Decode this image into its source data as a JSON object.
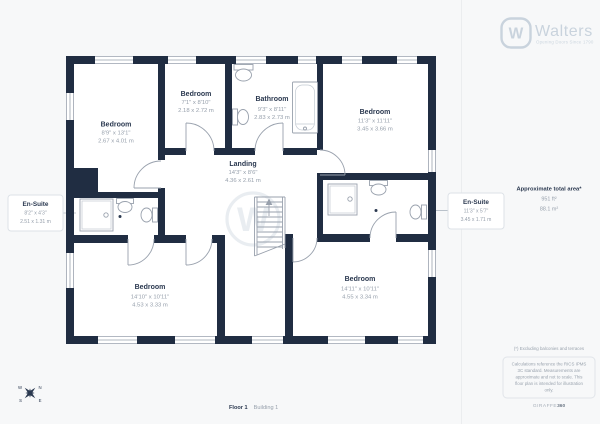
{
  "brand": {
    "monogram": "W",
    "name": "Walters",
    "tagline": "Opening Doors Since 1790"
  },
  "watermark": "W",
  "rooms": [
    {
      "name": "Bedroom",
      "imperial": "8'9\" x 13'1\"",
      "metric": "2.67 x 4.01 m"
    },
    {
      "name": "Bedroom",
      "imperial": "7'1\" x 8'10\"",
      "metric": "2.18 x 2.72 m"
    },
    {
      "name": "Bathroom",
      "imperial": "9'3\" x 8'11\"",
      "metric": "2.83 x 2.73 m"
    },
    {
      "name": "Bedroom",
      "imperial": "11'3\" x 11'11\"",
      "metric": "3.45 x 3.66 m"
    },
    {
      "name": "Landing",
      "imperial": "14'3\" x 8'6\"",
      "metric": "4.36 x 2.61 m"
    },
    {
      "name": "Bedroom",
      "imperial": "14'10\" x 10'11\"",
      "metric": "4.53 x 3.33 m"
    },
    {
      "name": "Bedroom",
      "imperial": "14'11\" x 10'11\"",
      "metric": "4.55 x 3.34 m"
    }
  ],
  "ensuites": [
    {
      "name": "En-Suite",
      "imperial": "8'2\" x 4'3\"",
      "metric": "2.51 x 1.31 m"
    },
    {
      "name": "En-Suite",
      "imperial": "11'3\" x 5'7\"",
      "metric": "3.45 x 1.71 m"
    }
  ],
  "summary": {
    "title": "Approximate total area*",
    "imperial": "951 ft²",
    "metric": "88.1 m²"
  },
  "footnote": "(*) Excluding balconies and terraces",
  "disclaimer_lines": [
    "Calculations reference the RICS IPMS",
    "3C standard. Measurements are",
    "approximate and not to scale. This",
    "floor plan is intended for illustration",
    "only."
  ],
  "provider": {
    "name": "GIRAFFE",
    "suffix": "360"
  },
  "footer": {
    "floor": "Floor 1",
    "building": "Building 1"
  },
  "compass": {
    "n": "N",
    "e": "E",
    "s": "S",
    "w": "W"
  },
  "colors": {
    "wall": "#202d42",
    "line": "#99a1ad",
    "label": "#2b3950",
    "muted": "#97a0ac",
    "logo": "#c9d3dd",
    "background": "#f7f8f9"
  }
}
